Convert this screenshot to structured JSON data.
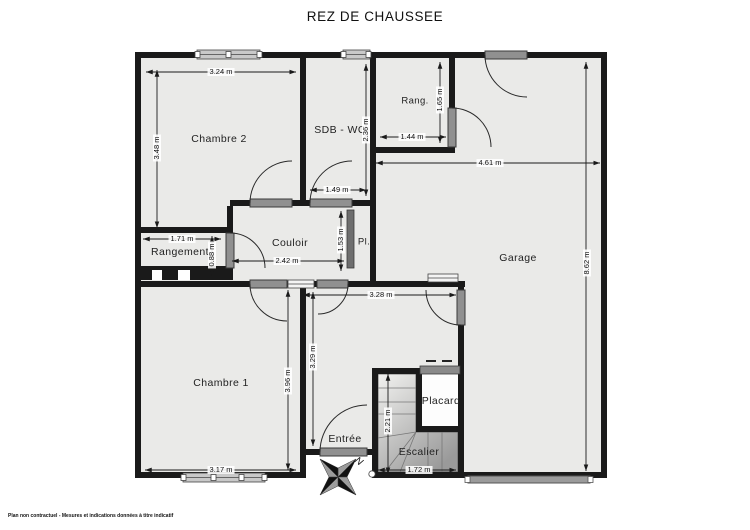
{
  "title": "REZ DE CHAUSSEE",
  "footer_disclaimer": "Plan non contractuel - Mesures et indications données à titre indicatif",
  "compass": {
    "north_label": "N"
  },
  "colors": {
    "wall": "#1a1a1a",
    "floor": "#eaeae8",
    "door_panel": "#909090",
    "placard_slider": "#6e6e6e",
    "garage_door": "#9b9b9b",
    "stair_dark": "#9a9a9a"
  },
  "rooms": [
    {
      "id": "chambre-2",
      "label": "Chambre 2"
    },
    {
      "id": "sdb-wc",
      "label": "SDB - WC"
    },
    {
      "id": "rang",
      "label": "Rang."
    },
    {
      "id": "garage",
      "label": "Garage"
    },
    {
      "id": "rangement",
      "label": "Rangement"
    },
    {
      "id": "couloir",
      "label": "Couloir"
    },
    {
      "id": "pl",
      "label": "Pl."
    },
    {
      "id": "chambre-1",
      "label": "Chambre 1"
    },
    {
      "id": "entree",
      "label": "Entrée"
    },
    {
      "id": "placard",
      "label": "Placard"
    },
    {
      "id": "escalier",
      "label": "Escalier"
    }
  ],
  "dimensions": [
    {
      "id": "chambre2-width",
      "label": "3.24 m"
    },
    {
      "id": "chambre2-height",
      "label": "3.48 m"
    },
    {
      "id": "sdb-width",
      "label": "1.49 m"
    },
    {
      "id": "sdb-height",
      "label": "2.36 m"
    },
    {
      "id": "rang-width",
      "label": "1.44 m"
    },
    {
      "id": "rang-height",
      "label": "1.65 m"
    },
    {
      "id": "garage-width",
      "label": "4.61 m"
    },
    {
      "id": "garage-height",
      "label": "8.62 m"
    },
    {
      "id": "rangement-width",
      "label": "1.71 m"
    },
    {
      "id": "rangement-height",
      "label": "0.88 m"
    },
    {
      "id": "couloir-width",
      "label": "2.42 m"
    },
    {
      "id": "couloir-height",
      "label": "1.53 m"
    },
    {
      "id": "chambre1-width",
      "label": "3.17 m"
    },
    {
      "id": "chambre1-height",
      "label": "3.96 m"
    },
    {
      "id": "entree-height",
      "label": "3.29 m"
    },
    {
      "id": "entree-width",
      "label": "3.28 m"
    },
    {
      "id": "escalier-height",
      "label": "2.21 m"
    },
    {
      "id": "escalier-width",
      "label": "1.72 m"
    }
  ]
}
